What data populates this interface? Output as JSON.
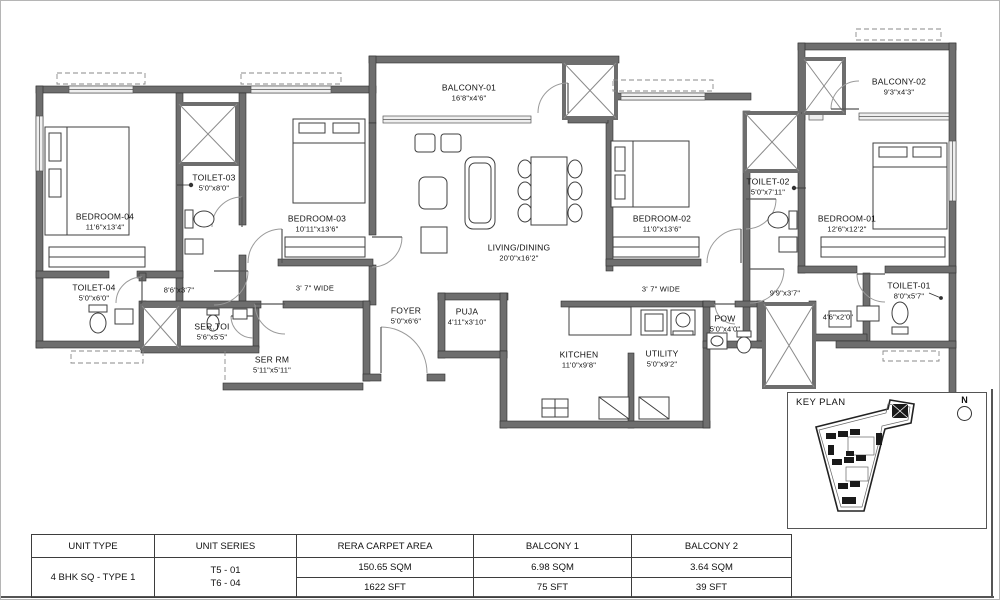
{
  "rooms": {
    "bedroom04": {
      "name": "BEDROOM-04",
      "dim": "11'6\"x13'4\""
    },
    "toilet03": {
      "name": "TOILET-03",
      "dim": "5'0\"x8'0\""
    },
    "bedroom03": {
      "name": "BEDROOM-03",
      "dim": "10'11\"x13'6\""
    },
    "balcony01": {
      "name": "BALCONY-01",
      "dim": "16'8\"x4'6\""
    },
    "living": {
      "name": "LIVING/DINING",
      "dim": "20'0\"x16'2\""
    },
    "bedroom02": {
      "name": "BEDROOM-02",
      "dim": "11'0\"x13'6\""
    },
    "toilet02": {
      "name": "TOILET-02",
      "dim": "5'0\"x7'11\""
    },
    "balcony02": {
      "name": "BALCONY-02",
      "dim": "9'3\"x4'3\""
    },
    "bedroom01": {
      "name": "BEDROOM-01",
      "dim": "12'6\"x12'2\""
    },
    "toilet01": {
      "name": "TOILET-01",
      "dim": "8'0\"x5'7\""
    },
    "toilet04": {
      "name": "TOILET-04",
      "dim": "5'0\"x6'0\""
    },
    "sertoi": {
      "name": "SER.TOI",
      "dim": "5'6\"x5'5\""
    },
    "serrm": {
      "name": "SER RM",
      "dim": "5'11\"x5'11\""
    },
    "foyer": {
      "name": "FOYER",
      "dim": "5'0\"x6'6\""
    },
    "puja": {
      "name": "PUJA",
      "dim": "4'11\"x3'10\""
    },
    "kitchen": {
      "name": "KITCHEN",
      "dim": "11'0\"x9'8\""
    },
    "utility": {
      "name": "UTILITY",
      "dim": "5'0\"x9'2\""
    },
    "pow": {
      "name": "POW",
      "dim": "5'0\"x4'0\""
    }
  },
  "passages": {
    "p1": "8'6\"x3'7\"",
    "corridor_left": "3' 7\" WIDE",
    "corridor_right": "3' 7\" WIDE",
    "p2": "9'9\"x3'7\"",
    "p3": "4'6\"x2'0\""
  },
  "key_plan": {
    "title": "KEY PLAN",
    "north": "N"
  },
  "table": {
    "headers": {
      "unit_type": "UNIT TYPE",
      "unit_series": "UNIT SERIES",
      "rera": "RERA CARPET AREA",
      "balcony1": "BALCONY 1",
      "balcony2": "BALCONY 2"
    },
    "unit_type": "4 BHK SQ - TYPE 1",
    "unit_series_1": "T5 - 01",
    "unit_series_2": "T6 - 04",
    "rera_sqm": "150.65 SQM",
    "rera_sft": "1622 SFT",
    "balcony1_sqm": "6.98 SQM",
    "balcony1_sft": "75 SFT",
    "balcony2_sqm": "3.64 SQM",
    "balcony2_sft": "39 SFT"
  },
  "colors": {
    "wall": "#6e6e6e",
    "line": "#2e2e2e",
    "text": "#111111"
  }
}
